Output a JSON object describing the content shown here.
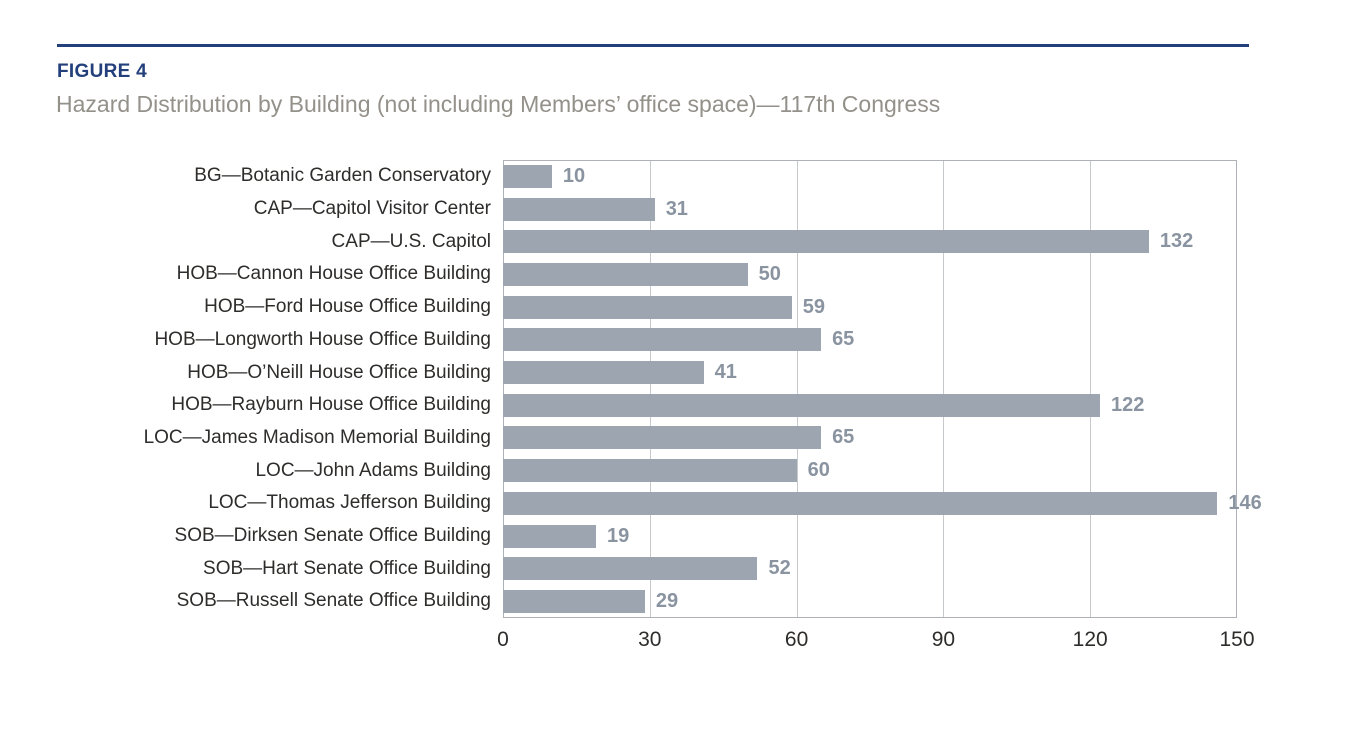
{
  "figure": {
    "label": "FIGURE 4",
    "title": "Hazard Distribution by Building (not including Members’ office space)—117th Congress"
  },
  "colors": {
    "accent": "#24407c",
    "subtitle": "#94908a",
    "bar": "#9da6b0",
    "value": "#8a94a1",
    "label": "#2e2d2b",
    "grid": "#c6cacd",
    "border": "#aeb2b6"
  },
  "chart_data": {
    "type": "bar",
    "orientation": "horizontal",
    "title": "Hazard Distribution by Building (not including Members’ office space)—117th Congress",
    "categories": [
      "BG—Botanic Garden Conservatory",
      "CAP—Capitol Visitor Center",
      "CAP—U.S. Capitol",
      "HOB—Cannon House Office Building",
      "HOB—Ford House Office Building",
      "HOB—Longworth House Office Building",
      "HOB—O’Neill House Office Building",
      "HOB—Rayburn House Office Building",
      "LOC—James Madison Memorial Building",
      "LOC—John Adams Building",
      "LOC—Thomas Jefferson Building",
      "SOB—Dirksen Senate Office Building",
      "SOB—Hart Senate Office Building",
      "SOB—Russell Senate Office Building"
    ],
    "values": [
      10,
      31,
      132,
      50,
      59,
      65,
      41,
      122,
      65,
      60,
      146,
      19,
      52,
      29
    ],
    "x_ticks": [
      0,
      30,
      60,
      90,
      120,
      150
    ],
    "xlim": [
      0,
      150
    ],
    "xlabel": "",
    "ylabel": "",
    "value_labels": true,
    "grid": true,
    "legend": false
  }
}
